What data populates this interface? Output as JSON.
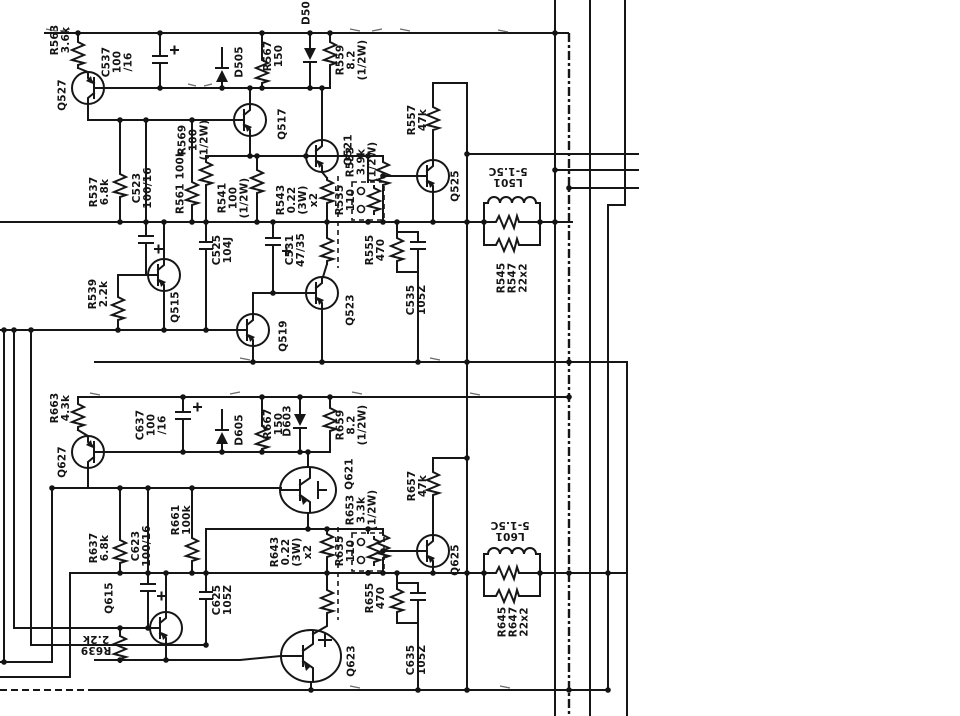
{
  "diagram": {
    "figure_type": "circuit-schematic-scan",
    "colors": {
      "ink": "#161616",
      "background": "#ffffff"
    },
    "labels": [
      {
        "id": "r563",
        "text": "R563\n3.6k",
        "x": 61,
        "y": 40,
        "rot": -90
      },
      {
        "id": "q527",
        "text": "Q527",
        "x": 63,
        "y": 95,
        "rot": -90
      },
      {
        "id": "c537",
        "text": "C537\n100\n/16",
        "x": 118,
        "y": 62,
        "rot": -90
      },
      {
        "id": "d505",
        "text": "D505",
        "x": 240,
        "y": 62,
        "rot": -90
      },
      {
        "id": "r567",
        "text": "R567\n150",
        "x": 274,
        "y": 56,
        "rot": -90
      },
      {
        "id": "d503-cut",
        "text": "D50",
        "x": 307,
        "y": 13,
        "rot": -90
      },
      {
        "id": "r559",
        "text": "R559\n8.2\n(1/2W)",
        "x": 352,
        "y": 60,
        "rot": -90
      },
      {
        "id": "q517",
        "text": "Q517",
        "x": 283,
        "y": 124,
        "rot": -90
      },
      {
        "id": "r569",
        "text": "R569\n100\n(1/2W)",
        "x": 194,
        "y": 140,
        "rot": -90
      },
      {
        "id": "r561",
        "text": "R561 100k",
        "x": 181,
        "y": 182,
        "rot": -90
      },
      {
        "id": "r537",
        "text": "R537\n6.8k",
        "x": 100,
        "y": 192,
        "rot": -90
      },
      {
        "id": "c523",
        "text": "C523\n100/16",
        "x": 143,
        "y": 188,
        "rot": -90
      },
      {
        "id": "r541",
        "text": "R541\n100\n(1/2W)",
        "x": 234,
        "y": 198,
        "rot": -90
      },
      {
        "id": "r543",
        "text": "R543\n0.22\n(3W)\nx2",
        "x": 298,
        "y": 200,
        "rot": -90
      },
      {
        "id": "q521",
        "text": "Q521",
        "x": 349,
        "y": 150,
        "rot": -90
      },
      {
        "id": "r553",
        "text": "R553\n3.9k\n(1/2W)",
        "x": 362,
        "y": 162,
        "rot": -90
      },
      {
        "id": "r557",
        "text": "R557\n47k",
        "x": 418,
        "y": 120,
        "rot": -90
      },
      {
        "id": "q525",
        "text": "Q525",
        "x": 456,
        "y": 186,
        "rot": -90
      },
      {
        "id": "r535",
        "text": "R535\n110",
        "x": 346,
        "y": 200,
        "rot": -90
      },
      {
        "id": "c525",
        "text": "C525\n104J",
        "x": 223,
        "y": 250,
        "rot": -90
      },
      {
        "id": "c531",
        "text": "C531\n47/35",
        "x": 296,
        "y": 250,
        "rot": -90
      },
      {
        "id": "r555",
        "text": "R555\n470",
        "x": 376,
        "y": 250,
        "rot": -90
      },
      {
        "id": "c535",
        "text": "C535\n105Z",
        "x": 417,
        "y": 300,
        "rot": -90
      },
      {
        "id": "q515",
        "text": "Q515",
        "x": 176,
        "y": 307,
        "rot": -90
      },
      {
        "id": "r539",
        "text": "R539\n2.2k",
        "x": 99,
        "y": 294,
        "rot": -90
      },
      {
        "id": "q519",
        "text": "Q519",
        "x": 284,
        "y": 336,
        "rot": -90
      },
      {
        "id": "q523",
        "text": "Q523",
        "x": 351,
        "y": 310,
        "rot": -90
      },
      {
        "id": "l501",
        "text": "L501\n5-1.5C",
        "x": 508,
        "y": 176,
        "rot": 180
      },
      {
        "id": "r545-r547",
        "text": "R545\nR547\n22x2",
        "x": 513,
        "y": 278,
        "rot": -90
      },
      {
        "id": "r663",
        "text": "R663\n4.3k",
        "x": 61,
        "y": 408,
        "rot": -90
      },
      {
        "id": "q627",
        "text": "Q627",
        "x": 63,
        "y": 462,
        "rot": -90
      },
      {
        "id": "c637",
        "text": "C637\n100\n/16",
        "x": 152,
        "y": 425,
        "rot": -90
      },
      {
        "id": "d605",
        "text": "D605",
        "x": 240,
        "y": 430,
        "rot": -90
      },
      {
        "id": "r667",
        "text": "R667\n150",
        "x": 274,
        "y": 424,
        "rot": -90
      },
      {
        "id": "d603",
        "text": "D603",
        "x": 288,
        "y": 421,
        "rot": -90
      },
      {
        "id": "r659",
        "text": "R659\n8.2\n(1/2W)",
        "x": 352,
        "y": 425,
        "rot": -90
      },
      {
        "id": "q621",
        "text": "Q621",
        "x": 350,
        "y": 474,
        "rot": -90
      },
      {
        "id": "r653",
        "text": "R653\n3.3k\n(1/2W)",
        "x": 362,
        "y": 510,
        "rot": -90
      },
      {
        "id": "r661",
        "text": "R661\n100k",
        "x": 182,
        "y": 520,
        "rot": -90
      },
      {
        "id": "r637",
        "text": "R637\n6.8k",
        "x": 100,
        "y": 548,
        "rot": -90
      },
      {
        "id": "c623",
        "text": "C623\n100/16",
        "x": 142,
        "y": 546,
        "rot": -90
      },
      {
        "id": "r643",
        "text": "R643\n0.22\n(3W)\nx2",
        "x": 292,
        "y": 552,
        "rot": -90
      },
      {
        "id": "r635",
        "text": "R635\n110",
        "x": 346,
        "y": 551,
        "rot": -90
      },
      {
        "id": "r657",
        "text": "R657\n47k",
        "x": 418,
        "y": 486,
        "rot": -90
      },
      {
        "id": "q625",
        "text": "Q625",
        "x": 456,
        "y": 560,
        "rot": -90
      },
      {
        "id": "r655",
        "text": "R655\n470",
        "x": 376,
        "y": 598,
        "rot": -90
      },
      {
        "id": "c625",
        "text": "C625\n105Z",
        "x": 223,
        "y": 600,
        "rot": -90
      },
      {
        "id": "c635",
        "text": "C635\n105Z",
        "x": 417,
        "y": 660,
        "rot": -90
      },
      {
        "id": "q615",
        "text": "Q615",
        "x": 110,
        "y": 598,
        "rot": -90
      },
      {
        "id": "r639",
        "text": "R639\n2.2k",
        "x": 96,
        "y": 644,
        "rot": 180
      },
      {
        "id": "q623",
        "text": "Q623",
        "x": 352,
        "y": 661,
        "rot": -90
      },
      {
        "id": "l601",
        "text": "L601\n5-1.5C",
        "x": 510,
        "y": 530,
        "rot": 180
      },
      {
        "id": "r645-r647",
        "text": "R645\nR647\n22x2",
        "x": 514,
        "y": 622,
        "rot": -90
      }
    ]
  }
}
